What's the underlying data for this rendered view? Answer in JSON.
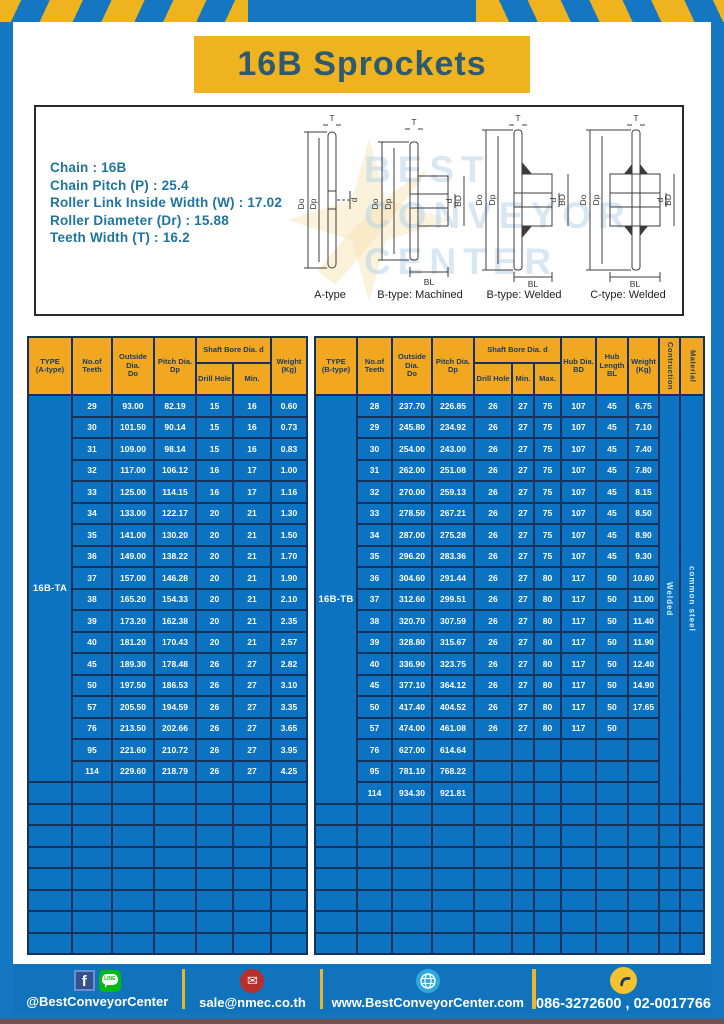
{
  "title": "16B Sprockets",
  "colors": {
    "frame_blue": "#1577c2",
    "accent_yellow": "#efb320",
    "table_blue": "#0b73c1",
    "header_orange": "#f1a71f",
    "grid_navy": "#16325a",
    "footer_blue": "#1173bb"
  },
  "specs": {
    "lines": [
      "Chain : 16B",
      "Chain Pitch (P) : 25.4",
      "Roller Link Inside Width (W) : 17.02",
      "Roller Diameter (Dr) : 15.88",
      "Teeth Width (T) : 16.2"
    ]
  },
  "watermark": {
    "text": "BEST\nCONVEYOR\nCENTER"
  },
  "diagrams": {
    "labels": {
      "T": "T",
      "Do": "Do",
      "Dp": "Dp",
      "d": "d",
      "BD": "BD",
      "BL": "BL"
    },
    "captions": [
      "A-type",
      "B-type: Machined",
      "B-type: Welded",
      "C-type: Welded"
    ]
  },
  "tables": {
    "A": {
      "header": {
        "type": "TYPE\n(A-type)",
        "teeth": "No.of\nTeeth",
        "outside": "Outside\nDia.\nDo",
        "pitch": "Pitch Dia.\nDp",
        "shaft": "Shaft Bore Dia. d",
        "drill": "Drill Hole",
        "min": "Min.",
        "weight": "Weight\n(Kg)"
      },
      "type_label": "16B-TA",
      "empty_rows": 8,
      "rows": [
        [
          "29",
          "93.00",
          "82.19",
          "15",
          "16",
          "0.60"
        ],
        [
          "30",
          "101.50",
          "90.14",
          "15",
          "16",
          "0.73"
        ],
        [
          "31",
          "109.00",
          "98.14",
          "15",
          "16",
          "0.83"
        ],
        [
          "32",
          "117.00",
          "106.12",
          "16",
          "17",
          "1.00"
        ],
        [
          "33",
          "125.00",
          "114.15",
          "16",
          "17",
          "1.16"
        ],
        [
          "34",
          "133.00",
          "122.17",
          "20",
          "21",
          "1.30"
        ],
        [
          "35",
          "141.00",
          "130.20",
          "20",
          "21",
          "1.50"
        ],
        [
          "36",
          "149.00",
          "138.22",
          "20",
          "21",
          "1.70"
        ],
        [
          "37",
          "157.00",
          "146.28",
          "20",
          "21",
          "1.90"
        ],
        [
          "38",
          "165.20",
          "154.33",
          "20",
          "21",
          "2.10"
        ],
        [
          "39",
          "173.20",
          "162.38",
          "20",
          "21",
          "2.35"
        ],
        [
          "40",
          "181.20",
          "170.43",
          "20",
          "21",
          "2.57"
        ],
        [
          "45",
          "189.30",
          "178.48",
          "26",
          "27",
          "2.82"
        ],
        [
          "50",
          "197.50",
          "186.53",
          "26",
          "27",
          "3.10"
        ],
        [
          "57",
          "205.50",
          "194.59",
          "26",
          "27",
          "3.35"
        ],
        [
          "76",
          "213.50",
          "202.66",
          "26",
          "27",
          "3.65"
        ],
        [
          "95",
          "221.60",
          "210.72",
          "26",
          "27",
          "3.95"
        ],
        [
          "114",
          "229.60",
          "218.79",
          "26",
          "27",
          "4.25"
        ]
      ]
    },
    "B": {
      "header": {
        "type": "TYPE\n(B-type)",
        "teeth": "No.of\nTeeth",
        "outside": "Outside\nDia.\nDo",
        "pitch": "Pitch Dia.\nDp",
        "shaft": "Shaft Bore Dia. d",
        "drill": "Drill Hole",
        "min": "Min.",
        "max": "Max.",
        "hub_dia": "Hub Dia.\nBD",
        "hub_len": "Hub\nLength\nBL",
        "weight": "Weight\n(Kg)",
        "construction": "Contruction",
        "material": "Material"
      },
      "type_label": "16B-TB",
      "construction": "Welded",
      "material": "common steel",
      "empty_rows": 7,
      "rows": [
        [
          "28",
          "237.70",
          "226.85",
          "26",
          "27",
          "75",
          "107",
          "45",
          "6.75"
        ],
        [
          "29",
          "245.80",
          "234.92",
          "26",
          "27",
          "75",
          "107",
          "45",
          "7.10"
        ],
        [
          "30",
          "254.00",
          "243.00",
          "26",
          "27",
          "75",
          "107",
          "45",
          "7.40"
        ],
        [
          "31",
          "262.00",
          "251.08",
          "26",
          "27",
          "75",
          "107",
          "45",
          "7.80"
        ],
        [
          "32",
          "270.00",
          "259.13",
          "26",
          "27",
          "75",
          "107",
          "45",
          "8.15"
        ],
        [
          "33",
          "278.50",
          "267.21",
          "26",
          "27",
          "75",
          "107",
          "45",
          "8.50"
        ],
        [
          "34",
          "287.00",
          "275.28",
          "26",
          "27",
          "75",
          "107",
          "45",
          "8.90"
        ],
        [
          "35",
          "296.20",
          "283.36",
          "26",
          "27",
          "75",
          "107",
          "45",
          "9.30"
        ],
        [
          "36",
          "304.60",
          "291.44",
          "26",
          "27",
          "80",
          "117",
          "50",
          "10.60"
        ],
        [
          "37",
          "312.60",
          "299.51",
          "26",
          "27",
          "80",
          "117",
          "50",
          "11.00"
        ],
        [
          "38",
          "320.70",
          "307.59",
          "26",
          "27",
          "80",
          "117",
          "50",
          "11.40"
        ],
        [
          "39",
          "328.80",
          "315.67",
          "26",
          "27",
          "80",
          "117",
          "50",
          "11.90"
        ],
        [
          "40",
          "336.90",
          "323.75",
          "26",
          "27",
          "80",
          "117",
          "50",
          "12.40"
        ],
        [
          "45",
          "377.10",
          "364.12",
          "26",
          "27",
          "80",
          "117",
          "50",
          "14.90"
        ],
        [
          "50",
          "417.40",
          "404.52",
          "26",
          "27",
          "80",
          "117",
          "50",
          "17.65"
        ],
        [
          "57",
          "474.00",
          "461.08",
          "26",
          "27",
          "80",
          "117",
          "50",
          ""
        ],
        [
          "76",
          "627.00",
          "614.64",
          "",
          "",
          "",
          "",
          "",
          ""
        ],
        [
          "95",
          "781.10",
          "768.22",
          "",
          "",
          "",
          "",
          "",
          ""
        ],
        [
          "114",
          "934.30",
          "921.81",
          "",
          "",
          "",
          "",
          "",
          ""
        ]
      ]
    }
  },
  "footer": {
    "social_label": "@BestConveyorCenter",
    "line_text": "LINE",
    "fb_letter": "f",
    "mail_glyph": "✉",
    "email": "sale@nmec.co.th",
    "website": "www.BestConveyorCenter.com",
    "phones": "086-3272600 , 02-0017766"
  }
}
